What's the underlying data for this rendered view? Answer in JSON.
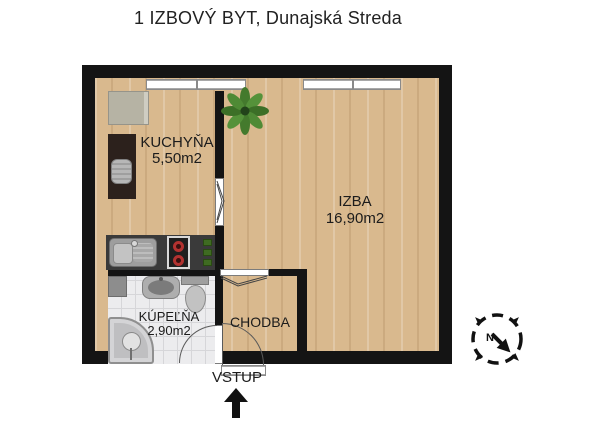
{
  "title": "1 IZBOVÝ BYT, Dunajská Streda",
  "rooms": {
    "kitchen": {
      "name": "KUCHYŇA",
      "area": "5,50m2"
    },
    "living_room": {
      "name": "IZBA",
      "area": "16,90m2"
    },
    "bathroom": {
      "name": "KÚPEĽŇA",
      "area": "2,90m2"
    },
    "hallway": {
      "name": "CHODBA"
    }
  },
  "entrance": {
    "label": "VSTUP"
  },
  "compass": {
    "north_label": "N"
  },
  "colors": {
    "wall": "#141414",
    "wood_floor": "#d9b98e",
    "tile_floor": "#ececee",
    "counter": "#3a3a3a",
    "plant": "#447a2d",
    "burner": "#b23230"
  }
}
